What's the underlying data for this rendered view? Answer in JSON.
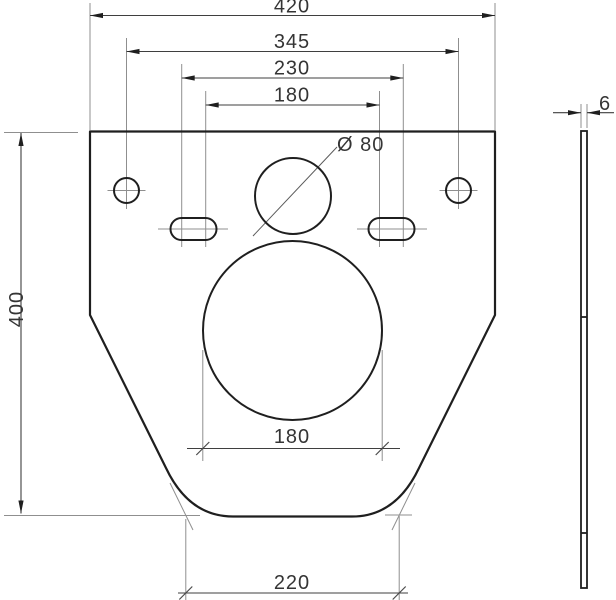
{
  "drawing_type": "dimensioned technical drawing of mounting plate with side view",
  "colors": {
    "background": "#ffffff",
    "outline": "#1f1f1f",
    "dimension_lines": "#3f3f3f",
    "extension_lines": "#8f8f8f",
    "text": "#353535"
  },
  "front_view": {
    "dimensions": {
      "overall_width": "420",
      "hole_spacing": "345",
      "slot_outer_spacing": "230",
      "slot_inner_spacing": "180",
      "overall_height": "400",
      "center_hole_diameter": "Ø 80",
      "bowl_opening_diameter": "180",
      "bottom_width": "220"
    }
  },
  "side_view": {
    "dimensions": {
      "thickness": "6"
    }
  }
}
